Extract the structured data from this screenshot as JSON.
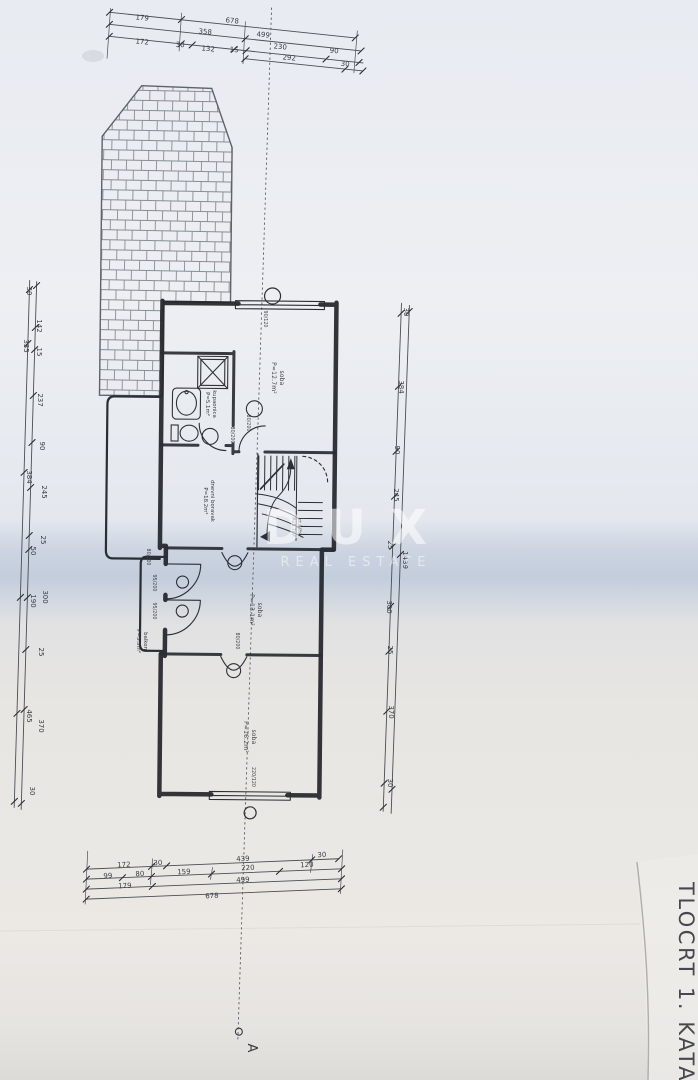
{
  "title": "TLOCRT 1. KATA",
  "section_marker": "A",
  "watermark": {
    "brand": "DUX",
    "tagline": "REAL ESTATE"
  },
  "colors": {
    "paper": "#eceef2",
    "fold_band": "#c3cddc",
    "ink": "#23262b"
  },
  "rooms": {
    "soba_top": {
      "name": "soba",
      "area": "P=12.7m²"
    },
    "kupaonica": {
      "name": "kupaonica",
      "area": "P=5.1m²"
    },
    "dnevni_boravak": {
      "name": "dnevni boravak",
      "area": "P=18.2m²"
    },
    "stubiste": {
      "name": "stubište",
      "area": "P=5.7m²"
    },
    "soba_middle": {
      "name": "soba",
      "area": "P=13.1m²"
    },
    "balkon": {
      "name": "balkon",
      "area": "P=5.3m²"
    },
    "soba_bottom": {
      "name": "soba",
      "area": "P=16.2m²"
    }
  },
  "openings": {
    "door_standard": "80/200",
    "door_balcony": "95/200",
    "window_top": "90/120",
    "window_bottom": "220/120"
  },
  "dims": {
    "top_row1": [
      "179",
      "678"
    ],
    "top_row2": [
      "358",
      "499"
    ],
    "top_row3": [
      "172",
      "30",
      "132",
      "15",
      "230",
      "90"
    ],
    "top_row4": [
      "292",
      "30"
    ],
    "left_col": [
      "30",
      "142",
      "335",
      "15",
      "237",
      "90",
      "384",
      "245",
      "25",
      "50",
      "300",
      "190",
      "25",
      "465",
      "370",
      "30"
    ],
    "right_col": [
      "30",
      "384",
      "90",
      "245",
      "25",
      "1439",
      "300",
      "25",
      "370",
      "30"
    ],
    "bottom_row1": [
      "172",
      "30",
      "439",
      "30"
    ],
    "bottom_row2": [
      "99",
      "80",
      "159",
      "220",
      "120"
    ],
    "bottom_row3": [
      "179",
      "499"
    ],
    "bottom_row4": [
      "678"
    ]
  }
}
